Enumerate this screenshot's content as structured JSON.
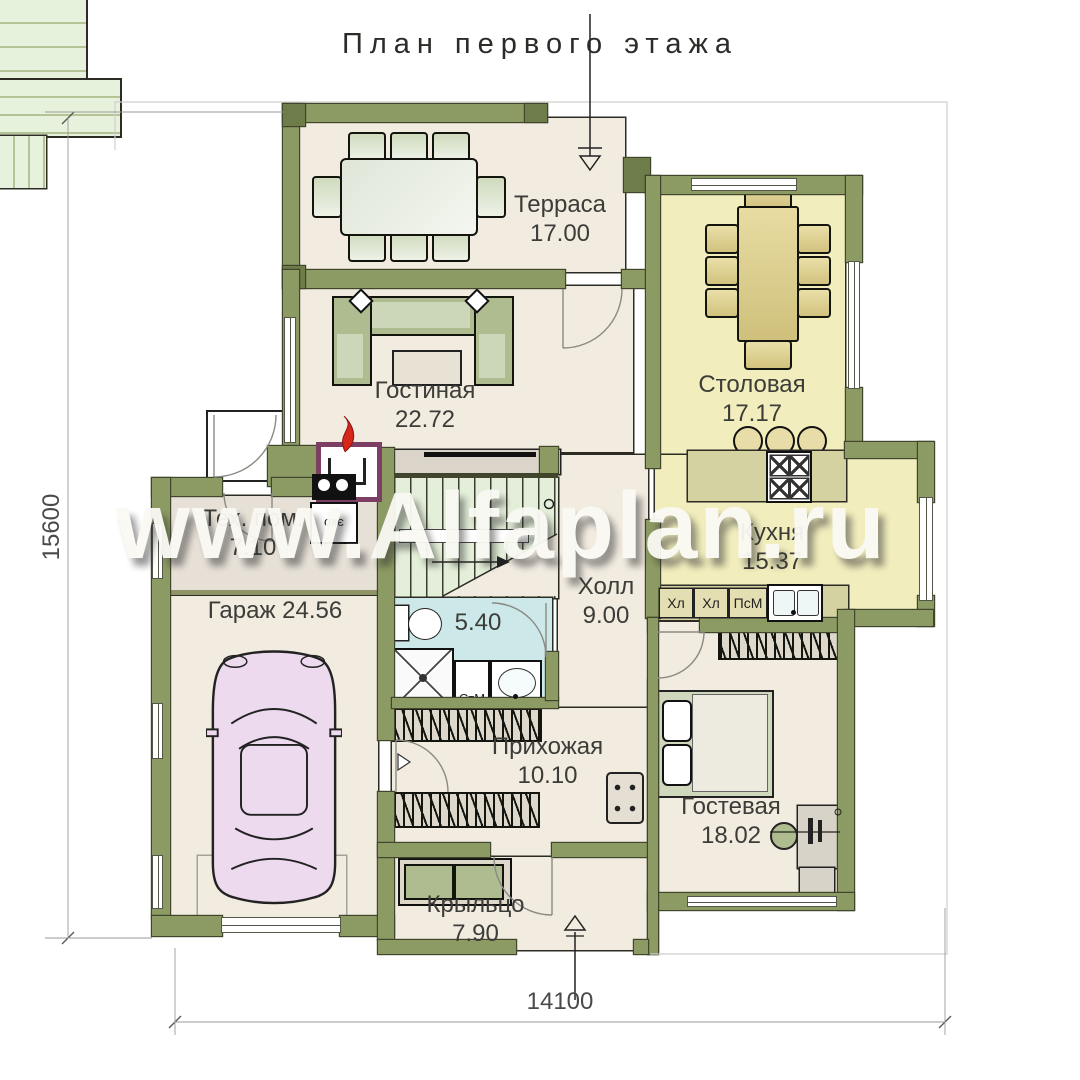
{
  "title": "План первого этажа",
  "watermark": "www.Alfaplan.ru",
  "dimensions": {
    "vertical": "15600",
    "horizontal": "14100"
  },
  "rooms": {
    "terrace": {
      "name": "Терраса",
      "area": "17.00"
    },
    "living": {
      "name": "Гостиная",
      "area": "22.72"
    },
    "dining": {
      "name": "Столовая",
      "area": "17.17"
    },
    "kitchen": {
      "name": "Кухня",
      "area": "15.37"
    },
    "tech": {
      "name": "Тех. пом.",
      "area": "7.10"
    },
    "garage": {
      "name": "Гараж",
      "area": "24.56"
    },
    "hall": {
      "name": "Холл",
      "area": "9.00"
    },
    "bath": {
      "area": "5.40"
    },
    "entry": {
      "name": "Прихожая",
      "area": "10.10"
    },
    "guest": {
      "name": "Гостевая",
      "area": "18.02"
    },
    "porch": {
      "name": "Крыльцо",
      "area": "7.90"
    }
  },
  "appliances": {
    "fridge1": "Хл",
    "fridge2": "Хл",
    "dishwasher": "ПсМ",
    "washer": "СтМ",
    "boiler": "эко"
  },
  "colors": {
    "wall": "#8c9a63",
    "floor": "#f1ebe0",
    "dining_floor": "#f1edbd",
    "bath_floor": "#cde8e8",
    "stairs": "#e3efd8",
    "flame": "#d6281a",
    "fireplace_frame": "#7c3f63",
    "car": "#eedaef",
    "counter": "#d5d2a2"
  }
}
